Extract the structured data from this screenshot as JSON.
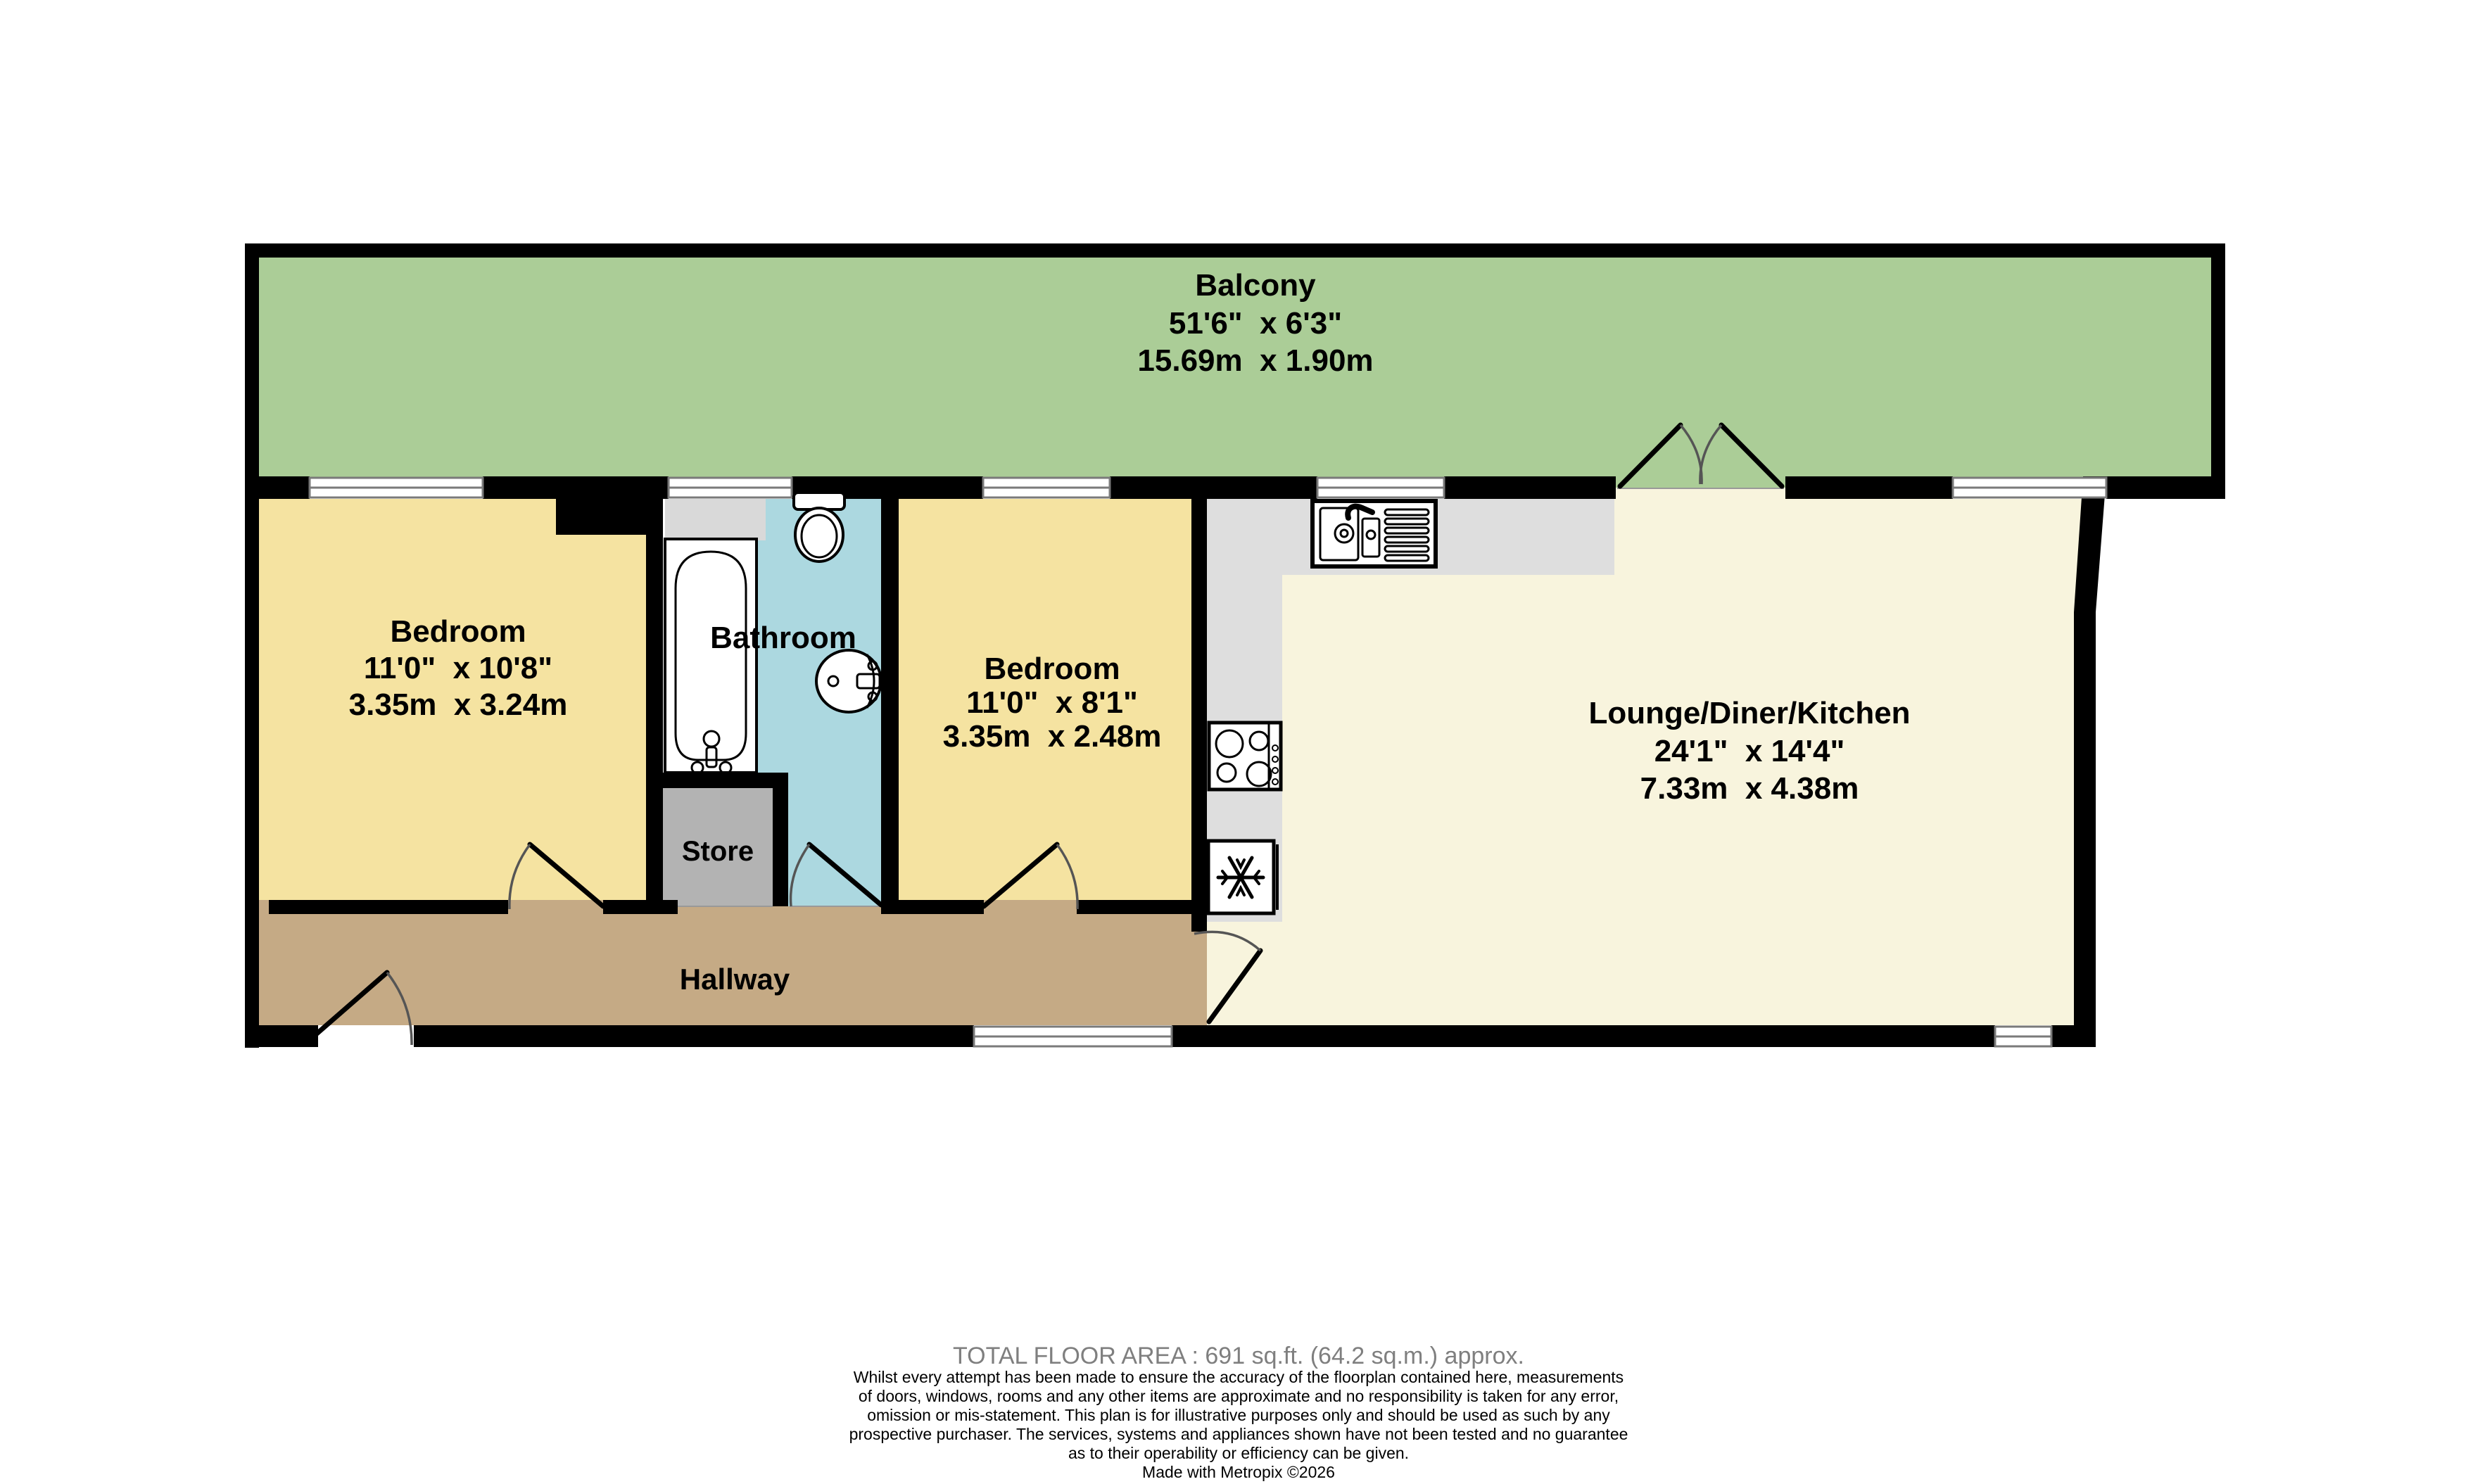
{
  "plan": {
    "rooms": {
      "balcony": {
        "name": "Balcony",
        "imperial": "51'6\"  x 6'3\"",
        "metric": "15.69m  x 1.90m"
      },
      "bedroom1": {
        "name": "Bedroom",
        "imperial": "11'0\"  x 10'8\"",
        "metric": "3.35m  x 3.24m"
      },
      "bathroom": {
        "name": "Bathroom"
      },
      "bedroom2": {
        "name": "Bedroom",
        "imperial": "11'0\"  x 8'1\"",
        "metric": "3.35m  x 2.48m"
      },
      "lounge": {
        "name": "Lounge/Diner/Kitchen",
        "imperial": "24'1\"  x 14'4\"",
        "metric": "7.33m  x 4.38m"
      },
      "store": {
        "name": "Store"
      },
      "hallway": {
        "name": "Hallway"
      }
    },
    "fixtures": [
      "bath",
      "toilet",
      "basin",
      "kitchen-sink",
      "hob",
      "fridge"
    ]
  },
  "colors": {
    "balcony": "#abcd97",
    "bedroom": "#f5e3a1",
    "bathroom": "#acd8e0",
    "lounge": "#f8f4dd",
    "hallway": "#c5aa85",
    "store": "#b3b3b3",
    "counter": "#dedede",
    "recess": "#d9d9d9",
    "wall": "#000000"
  },
  "footer": {
    "total_area": "TOTAL FLOOR AREA : 691 sq.ft. (64.2 sq.m.) approx.",
    "disclaimer": "Whilst every attempt has been made to ensure the accuracy of the floorplan contained here, measurements\nof doors, windows, rooms and any other items are approximate and no responsibility is taken for any error,\nomission or mis-statement. This plan is for illustrative purposes only and should be used as such by any\nprospective purchaser. The services, systems and appliances shown have not been tested and no guarantee\nas to their operability or efficiency can be given.",
    "credit": "Made with Metropix ©2026"
  }
}
